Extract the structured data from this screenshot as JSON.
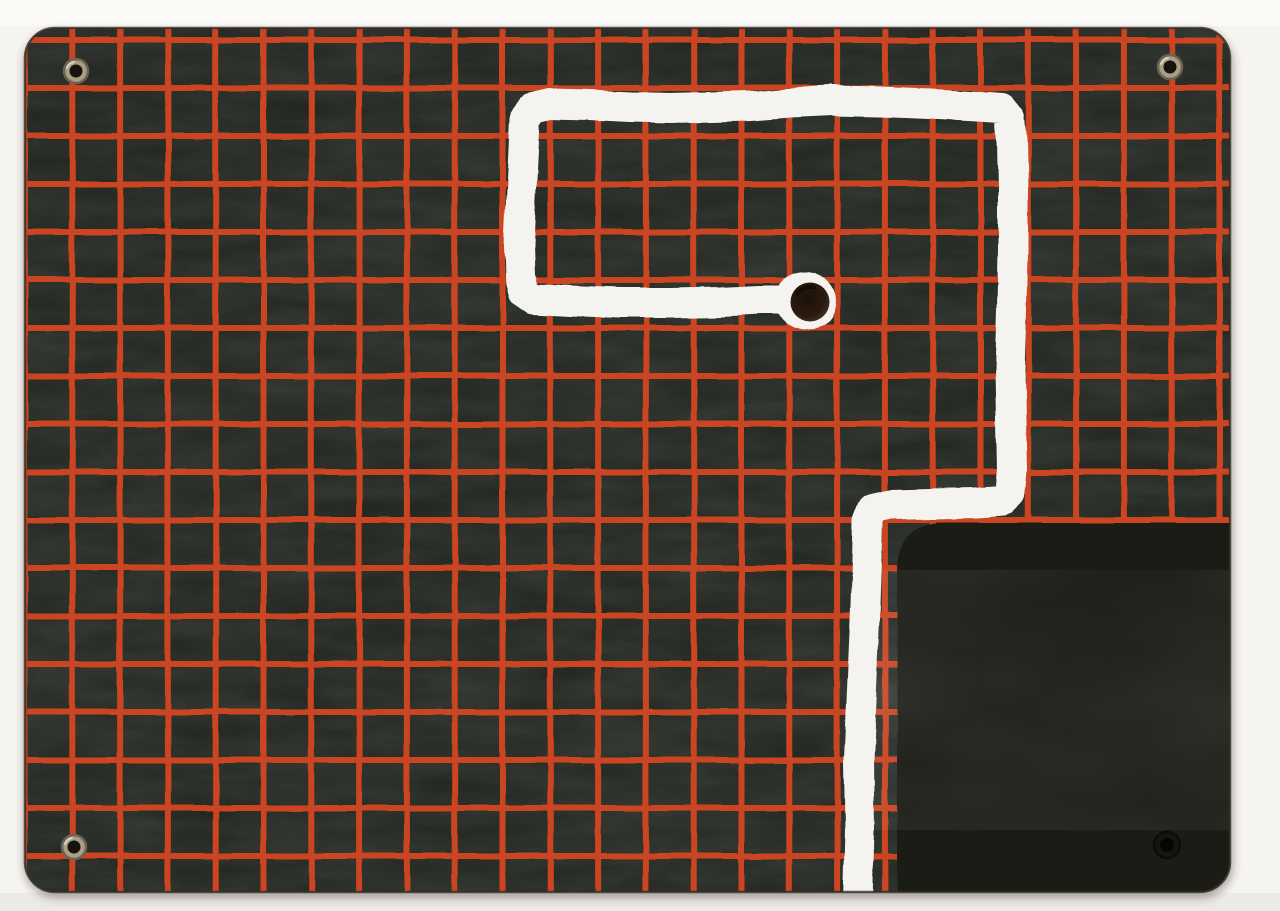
{
  "meta": {
    "description": "Scanned photograph of a dark slate panel printed with a red grid, four corner eyelets, a hand-painted white route ending in a drilled hole, and a black over-painted rectangle in the lower-right corner",
    "canvas": {
      "width": 1280,
      "height": 911
    }
  },
  "scene": {
    "background": {
      "main_color": "#f5f4f0",
      "top_band_color": "#fbfaf7",
      "bottom_band_color": "#eceae6",
      "bottom_band_y": 893
    },
    "board": {
      "x": 25,
      "y": 28,
      "width": 1205,
      "height": 864,
      "corner_radius": 30,
      "base_color": "#1e221d",
      "texture_light_color": "#8fa093",
      "edge_color": "#352d24",
      "shadow_color": "rgba(60,50,40,0.35)"
    },
    "grid": {
      "color": "#cc4520",
      "line_width": 6,
      "offset_x": 24.5,
      "spacing_x": 47.8,
      "vertical_count": 26,
      "offset_y": 40,
      "spacing_y": 48,
      "horizontal_count": 18
    },
    "dark_patch": {
      "left": 897,
      "top": 523,
      "corner_radius": 48,
      "color": "#1b1e18",
      "smear_color": "#262b22"
    },
    "painted_path": {
      "color": "#f5f3ef",
      "stroke_width": 30,
      "points": [
        [
          858,
          900
        ],
        [
          860,
          830
        ],
        [
          859,
          760
        ],
        [
          862,
          690
        ],
        [
          865,
          620
        ],
        [
          867,
          560
        ],
        [
          868,
          522
        ],
        [
          873,
          509
        ],
        [
          890,
          505
        ],
        [
          930,
          504
        ],
        [
          975,
          503
        ],
        [
          1002,
          501
        ],
        [
          1010,
          493
        ],
        [
          1012,
          470
        ],
        [
          1011,
          420
        ],
        [
          1010,
          370
        ],
        [
          1012,
          310
        ],
        [
          1013,
          250
        ],
        [
          1013,
          190
        ],
        [
          1012,
          140
        ],
        [
          1010,
          118
        ],
        [
          1002,
          108
        ],
        [
          970,
          106
        ],
        [
          930,
          104
        ],
        [
          880,
          102
        ],
        [
          830,
          101
        ],
        [
          790,
          103
        ],
        [
          750,
          106
        ],
        [
          710,
          107
        ],
        [
          670,
          108
        ],
        [
          630,
          107
        ],
        [
          590,
          105
        ],
        [
          550,
          104
        ],
        [
          533,
          108
        ],
        [
          525,
          120
        ],
        [
          523,
          160
        ],
        [
          521,
          200
        ],
        [
          519,
          245
        ],
        [
          520,
          275
        ],
        [
          524,
          292
        ],
        [
          534,
          299
        ],
        [
          570,
          301
        ],
        [
          620,
          303
        ],
        [
          670,
          303
        ],
        [
          720,
          302
        ],
        [
          760,
          300
        ],
        [
          795,
          300
        ]
      ]
    },
    "end_cap": {
      "cx": 806,
      "cy": 301,
      "blob_radius": 30,
      "hole_cx": 810,
      "hole_cy": 302,
      "hole_radius": 19.5,
      "hole_center_color": "#1c1009",
      "hole_mid_color": "#2a1b10",
      "hole_edge_color": "#55402a"
    },
    "eyelets": [
      {
        "id": "top-left",
        "cx": 76,
        "cy": 71,
        "outer_radius": 12,
        "inner_radius": 6.5,
        "ring_color": "#a89e86",
        "rim_color": "#6d6350",
        "hole_color": "#17120e",
        "painted_over": false
      },
      {
        "id": "top-right",
        "cx": 1170,
        "cy": 67,
        "outer_radius": 12,
        "inner_radius": 6.5,
        "ring_color": "#a89e86",
        "rim_color": "#6d6350",
        "hole_color": "#17120e",
        "painted_over": false
      },
      {
        "id": "bottom-left",
        "cx": 74,
        "cy": 847,
        "outer_radius": 12,
        "inner_radius": 6.5,
        "ring_color": "#a89e86",
        "rim_color": "#6d6350",
        "hole_color": "#17120e",
        "painted_over": false
      },
      {
        "id": "bottom-right",
        "cx": 1167,
        "cy": 845,
        "outer_radius": 13,
        "inner_radius": 7,
        "ring_color": "#15160f",
        "rim_color": "#0c0d09",
        "hole_color": "#060705",
        "painted_over": true
      }
    ]
  }
}
